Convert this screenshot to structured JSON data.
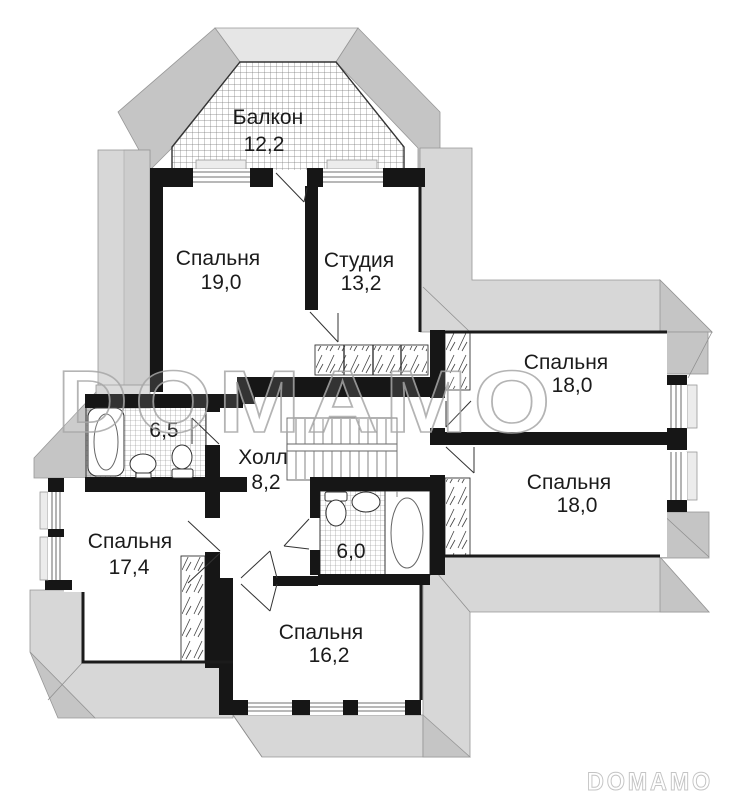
{
  "watermark": {
    "center_text": "DOMAMO",
    "footer_text": "DOMAMO"
  },
  "rooms": {
    "balcony": {
      "label": "Балкон",
      "area": "12,2"
    },
    "bedroom_top_left": {
      "label": "Спальня",
      "area": "19,0"
    },
    "studio": {
      "label": "Студия",
      "area": "13,2"
    },
    "bedroom_right_upper": {
      "label": "Спальня",
      "area": "18,0"
    },
    "bedroom_right_lower": {
      "label": "Спальня",
      "area": "18,0"
    },
    "bathroom_left": {
      "area": "6,5"
    },
    "hall": {
      "label": "Холл",
      "area": "8,2"
    },
    "bedroom_left": {
      "label": "Спальня",
      "area": "17,4"
    },
    "bathroom_center": {
      "area": "6,0"
    },
    "bedroom_bottom": {
      "label": "Спальня",
      "area": "16,2"
    }
  },
  "colors": {
    "wall": "#161616",
    "roof": "#d7d7d7",
    "roof_shade": "#c5c5c5",
    "roof_light": "#e6e6e6",
    "label": "#1b1b1b",
    "watermark_center": "#a8a8a8",
    "watermark_footer": "#c4c4c4"
  }
}
